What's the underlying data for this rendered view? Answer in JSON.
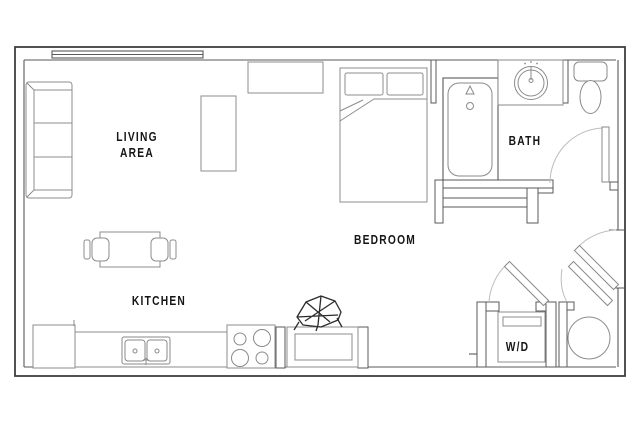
{
  "page": {
    "type": "studio-apartment-floor-plan",
    "background": "#ffffff"
  },
  "colors": {
    "outer_wall": "#3f3f3f",
    "inner_wall": "#5a5a5a",
    "furniture_line": "#8d8d8d",
    "door_arc": "#bdbdbd",
    "decor_line": "#2c2c2c",
    "label_text": "#151515"
  },
  "rooms": [
    {
      "name": "living-area",
      "lines": [
        "LIVING",
        "AREA"
      ]
    },
    {
      "name": "kitchen",
      "lines": [
        "KITCHEN"
      ]
    },
    {
      "name": "bedroom",
      "lines": [
        "BEDROOM"
      ]
    },
    {
      "name": "bath",
      "lines": [
        "BATH"
      ]
    },
    {
      "name": "laundry",
      "lines": [
        "W/D"
      ]
    }
  ],
  "fixtures": {
    "living": [
      "sofa",
      "coffee-table",
      "tv-console"
    ],
    "dining": [
      "dining-table",
      "chair-left",
      "chair-right"
    ],
    "kitchen": [
      "refrigerator",
      "counter",
      "double-sink",
      "stove-4-burners",
      "island",
      "decor-object"
    ],
    "bedroom": [
      "bed",
      "pillows",
      "console-table"
    ],
    "bath": [
      "bathtub",
      "vanity-sink",
      "toilet",
      "bath-door"
    ],
    "laundry": [
      "washer-dryer-unit",
      "closet-door"
    ],
    "utility": [
      "water-heater",
      "closet-door",
      "entry-door"
    ],
    "windows": [
      "top-wall-window"
    ]
  }
}
